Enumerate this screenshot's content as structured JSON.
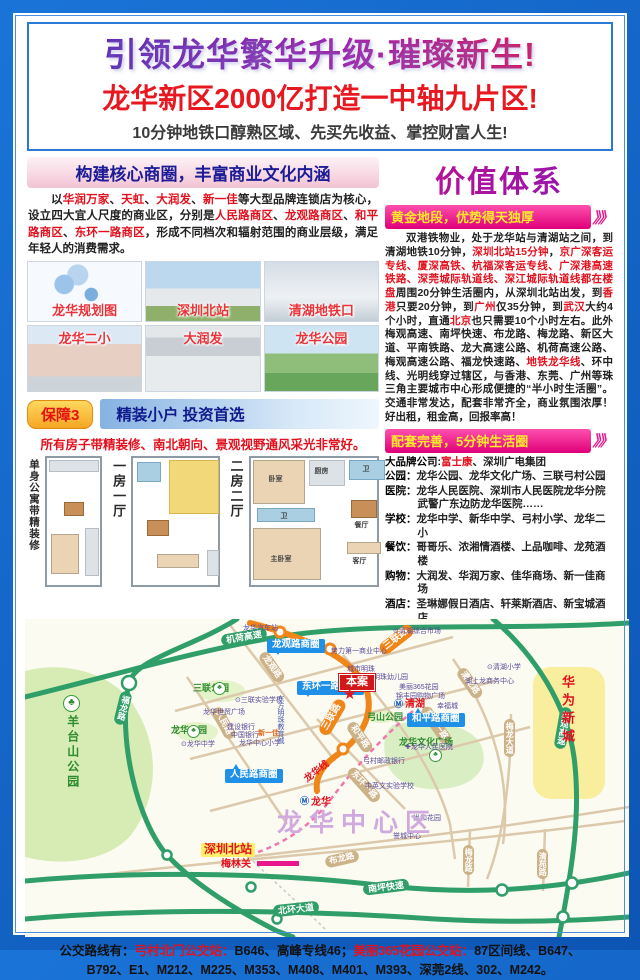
{
  "header": {
    "title1": "引领龙华繁华升级·璀璨新生!",
    "title2": "龙华新区2000亿打造一中轴九片区!",
    "title3": "10分钟地铁口醇熟区域、先买先收益、掌控财富人生!"
  },
  "left": {
    "header": "构建核心商圈，丰富商业文化内涵",
    "intro_segments": [
      {
        "t": "以"
      },
      {
        "t": "华润万家",
        "c": "r"
      },
      {
        "t": "、"
      },
      {
        "t": "天虹",
        "c": "r"
      },
      {
        "t": "、"
      },
      {
        "t": "大润发",
        "c": "r"
      },
      {
        "t": "、"
      },
      {
        "t": "新一佳",
        "c": "r"
      },
      {
        "t": "等大型品牌连锁店为核心，设立四大宜人尺度的商业区，分别是"
      },
      {
        "t": "人民路商区",
        "c": "r"
      },
      {
        "t": "、"
      },
      {
        "t": "龙观路商区",
        "c": "r"
      },
      {
        "t": "、"
      },
      {
        "t": "和平路商区",
        "c": "r"
      },
      {
        "t": "、"
      },
      {
        "t": "东环一路商区",
        "c": "r"
      },
      {
        "t": "，形成不同档次和辐射范围的商业层级，满足年轻人的消费需求。"
      }
    ],
    "photos": [
      {
        "caption": "龙华规划图"
      },
      {
        "caption": "深圳北站"
      },
      {
        "caption": "清湖地铁口"
      },
      {
        "caption": "龙华二小"
      },
      {
        "caption": "大润发"
      },
      {
        "caption": "龙华公园"
      }
    ],
    "guarantee": {
      "badge": "保障3",
      "header": "精装小户 投资首选",
      "note": "所有房子带精装修、南北朝向、景观视野通风采光非常好。"
    },
    "plans": [
      {
        "label": "单身公寓带精装修"
      },
      {
        "label": "一房一厅"
      },
      {
        "label": "二房二厅",
        "rooms": [
          "卧室",
          "厨房",
          "卫",
          "餐厅",
          "卫",
          "客厅",
          "主卧室"
        ]
      }
    ]
  },
  "right": {
    "title": "价值体系",
    "chevrons": "》》",
    "sections": [
      {
        "header": "黄金地段，优势得天独厚",
        "paragraph_segments": [
          {
            "t": "双港铁物业，处于龙华站与清湖站之间，到清湖地铁10分钟，"
          },
          {
            "t": "深圳北站15分钟",
            "c": "r"
          },
          {
            "t": "，"
          },
          {
            "t": "京广深客运专线、厦深高铁、杭福深客运专线、广深港高速铁路、深莞城际轨道线、深江城际轨道线都在楼盘",
            "c": "r"
          },
          {
            "t": "周围20分钟生活圈内，从深圳北站出发，到"
          },
          {
            "t": "香港",
            "c": "r"
          },
          {
            "t": "只要20分钟，到"
          },
          {
            "t": "广州",
            "c": "r"
          },
          {
            "t": "仅35分钟，到"
          },
          {
            "t": "武汉",
            "c": "r"
          },
          {
            "t": "大约4个小时，直通"
          },
          {
            "t": "北京",
            "c": "r"
          },
          {
            "t": "也只需要10个小时左右。此外梅观高速、南坪快速、布龙路、梅龙路、新区大道、平南铁路、龙大高速公路、机荷高速公路、梅观高速公路、福龙快速路、"
          },
          {
            "t": "地铁龙华线",
            "c": "r"
          },
          {
            "t": "、环中线、光明线穿过辖区，与香港、东莞、广州等珠三角主要城市中心形成便捷的“半小时生活圈”。交通非常发达，配套非常齐全，商业氛围浓厚！好出租，租金高，回报率高！"
          }
        ]
      },
      {
        "header": "配套完善，5分钟生活圈"
      },
      {
        "header": "靠山天然氧吧·风水宝地",
        "paragraph_segments": [
          {
            "t": "项目地处龙华新区旧改第一村(弓村)，青山近城，紧邻占地4万平方米的"
          },
          {
            "t": "原生态弓山公园",
            "c": "r"
          },
          {
            "t": "，"
          },
          {
            "t": "在风水学上形成“明堂之地”",
            "c": "r"
          },
          {
            "t": "，有着百年历史的弓山公园，孕育了多种珍贵树种以及鸟类、昆虫等生物，"
          },
          {
            "t": "是原生态、纯天然的氧吧",
            "c": "r"
          },
          {
            "t": "。"
          }
        ]
      }
    ],
    "amenities": [
      {
        "label": "大品牌公司:",
        "segs": [
          {
            "t": "富士康",
            "c": "r"
          },
          {
            "t": "、深圳广电集团"
          }
        ]
      },
      {
        "label": "公园：",
        "segs": [
          {
            "t": "龙华公园、龙华文化广场、三联弓村公园"
          }
        ]
      },
      {
        "label": "医院：",
        "segs": [
          {
            "t": "龙华人民医院、深圳市人民医院龙华分院 武警广东边防龙华医院……"
          }
        ]
      },
      {
        "label": "学校：",
        "segs": [
          {
            "t": "龙华中学、新华中学、弓村小学、龙华二小"
          }
        ]
      },
      {
        "label": "餐饮：",
        "segs": [
          {
            "t": "哥哥乐、浓湘情酒楼、上品咖啡、龙苑酒楼"
          }
        ]
      },
      {
        "label": "购物：",
        "segs": [
          {
            "t": "大润发、华润万家、佳华商场、新一佳商场"
          }
        ]
      },
      {
        "label": "酒店：",
        "segs": [
          {
            "t": "圣琳娜假日酒店、轩莱斯酒店、新宝城酒店"
          }
        ]
      },
      {
        "label": "银行：",
        "segs": [
          {
            "t": "四大银行,平安银行、中信银行、东亚银行"
          }
        ]
      }
    ]
  },
  "map": {
    "labels": [
      {
        "t": "机荷高速",
        "cls": "hw",
        "x": 196,
        "y": 12,
        "r": -10
      },
      {
        "t": "南坪快速",
        "cls": "hw",
        "x": 338,
        "y": 262,
        "r": -7
      },
      {
        "t": "北环大道",
        "cls": "hw",
        "x": 248,
        "y": 284,
        "r": -6
      },
      {
        "t": "福龙路",
        "cls": "hwv",
        "x": 92,
        "y": 72,
        "r": 14
      },
      {
        "t": "梅观高速",
        "cls": "hwv",
        "x": 532,
        "y": 88,
        "r": 10
      },
      {
        "t": "龙观路",
        "cls": "rd",
        "x": 230,
        "y": 42,
        "r": 55
      },
      {
        "t": "人民路",
        "cls": "rd",
        "x": 182,
        "y": 98,
        "r": 62
      },
      {
        "t": "东环一路",
        "cls": "rd",
        "x": 390,
        "y": 100,
        "r": 55
      },
      {
        "t": "东环一路",
        "cls": "rd",
        "x": 318,
        "y": 160,
        "r": 48
      },
      {
        "t": "和平路",
        "cls": "rd",
        "x": 318,
        "y": 112,
        "r": 55
      },
      {
        "t": "清龙路",
        "cls": "rd",
        "x": 428,
        "y": 58,
        "r": 55
      },
      {
        "t": "梅龙大道",
        "cls": "rdv",
        "x": 479,
        "y": 100
      },
      {
        "t": "布龙路",
        "cls": "rd",
        "x": 300,
        "y": 234,
        "r": -13
      },
      {
        "t": "梅龙路",
        "cls": "rdv",
        "x": 438,
        "y": 226
      },
      {
        "t": "清苑路",
        "cls": "rdv",
        "x": 512,
        "y": 230
      },
      {
        "t": "三联路",
        "cls": "mt",
        "x": 352,
        "y": 14,
        "r": -38
      },
      {
        "t": "三联路",
        "cls": "mt",
        "x": 288,
        "y": 92,
        "r": -60
      },
      {
        "t": "龙观路商圈",
        "cls": "biz",
        "x": 242,
        "y": 20
      },
      {
        "t": "东环一路商圈",
        "cls": "biz",
        "x": 272,
        "y": 62
      },
      {
        "t": "人民路商圈",
        "cls": "biz tt",
        "x": 200,
        "y": 150
      },
      {
        "t": "和平路商圈",
        "cls": "biz tt",
        "x": 382,
        "y": 94
      },
      {
        "t": "三联公园",
        "cls": "park",
        "x": 168,
        "y": 64
      },
      {
        "t": "龙华公园",
        "cls": "park",
        "x": 146,
        "y": 106
      },
      {
        "t": "弓山公园",
        "cls": "park",
        "x": 342,
        "y": 93
      },
      {
        "t": "龙华文化广场",
        "cls": "park",
        "x": 374,
        "y": 118
      },
      {
        "t": "羊台山公园",
        "cls": "parkv",
        "x": 40,
        "y": 96
      },
      {
        "t": "♣",
        "cls": "tree big",
        "x": 38,
        "y": 76
      },
      {
        "t": "♣",
        "cls": "tree",
        "x": 188,
        "y": 63
      },
      {
        "t": "♣",
        "cls": "tree",
        "x": 162,
        "y": 106
      },
      {
        "t": "♣",
        "cls": "tree",
        "x": 404,
        "y": 130
      },
      {
        "t": "龙华汽车站",
        "cls": "poi",
        "x": 218,
        "y": 6
      },
      {
        "t": "⊙清湖综合市场",
        "cls": "poi",
        "x": 368,
        "y": 9
      },
      {
        "t": "势力第一商业中心",
        "cls": "poi",
        "x": 306,
        "y": 29
      },
      {
        "t": "城市明珠",
        "cls": "poi",
        "x": 322,
        "y": 47
      },
      {
        "t": "太元明珠幼儿园",
        "cls": "poi",
        "x": 334,
        "y": 55
      },
      {
        "t": "美丽365花园",
        "cls": "poi",
        "x": 374,
        "y": 65
      },
      {
        "t": "锦丰园购物广场",
        "cls": "poi",
        "x": 371,
        "y": 74
      },
      {
        "t": "幸福城",
        "cls": "poi",
        "x": 412,
        "y": 84
      },
      {
        "t": "⊙清湖小学",
        "cls": "poi",
        "x": 462,
        "y": 45
      },
      {
        "t": "湖上龙商务中心",
        "cls": "poi",
        "x": 440,
        "y": 59
      },
      {
        "t": "⊙三联实验学校",
        "cls": "poi",
        "x": 210,
        "y": 78
      },
      {
        "t": "东方明珠教育城",
        "cls": "poiv",
        "x": 251,
        "y": 76
      },
      {
        "t": "龙华世贸广场",
        "cls": "poi",
        "x": 178,
        "y": 90
      },
      {
        "t": "建设银行",
        "cls": "poi",
        "x": 202,
        "y": 105
      },
      {
        "t": "中国银行",
        "cls": "poi",
        "x": 206,
        "y": 113
      },
      {
        "t": "新一佳",
        "cls": "poic",
        "x": 233,
        "y": 111
      },
      {
        "t": "龙华中心小学",
        "cls": "poi",
        "x": 214,
        "y": 121
      },
      {
        "t": "⊙龙华中学",
        "cls": "poi",
        "x": 156,
        "y": 122
      },
      {
        "t": "✚龙华人民医院",
        "cls": "poi",
        "x": 380,
        "y": 125
      },
      {
        "t": "弓村邮政银行",
        "cls": "poi",
        "x": 338,
        "y": 139
      },
      {
        "t": "中英文实验学校",
        "cls": "poi",
        "x": 340,
        "y": 164
      },
      {
        "t": "尚和花园",
        "cls": "poi",
        "x": 388,
        "y": 196
      },
      {
        "t": "誉城中心",
        "cls": "poi",
        "x": 368,
        "y": 214
      },
      {
        "t": "本案",
        "cls": "case",
        "x": 314,
        "y": 55
      },
      {
        "t": "★",
        "cls": "star",
        "x": 318,
        "y": 67
      },
      {
        "t": "清湖",
        "cls": "st",
        "x": 380,
        "y": 80
      },
      {
        "t": "Ⓜ",
        "cls": "mico",
        "x": 369,
        "y": 80
      },
      {
        "t": "龙华",
        "cls": "st",
        "x": 286,
        "y": 178
      },
      {
        "t": "Ⓜ",
        "cls": "mico",
        "x": 275,
        "y": 177
      },
      {
        "t": "龙华线",
        "cls": "stl",
        "x": 278,
        "y": 148,
        "r": -38
      },
      {
        "t": "龙华中心区",
        "cls": "bigarea",
        "x": 252,
        "y": 190
      },
      {
        "t": "华为新城",
        "cls": "vred",
        "x": 534,
        "y": 56
      },
      {
        "t": "深圳北站",
        "cls": "sbz",
        "x": 176,
        "y": 224
      },
      {
        "t": "梅林关",
        "cls": "mlg",
        "x": 196,
        "y": 240
      },
      {
        "t": "",
        "cls": "bar",
        "x": 232,
        "y": 242,
        "w": 42
      }
    ]
  },
  "bus": {
    "segments": [
      {
        "t": "公交路线有："
      },
      {
        "t": "弓村北门公交站：",
        "c": "r"
      },
      {
        "t": "B646、高峰专线46；"
      },
      {
        "t": "美丽365花园公交站：",
        "c": "r"
      },
      {
        "t": "87区间线、B647、B792、E1、M212、M225、M353、M408、M401、M393、深莞2线、302、M242。"
      }
    ]
  }
}
